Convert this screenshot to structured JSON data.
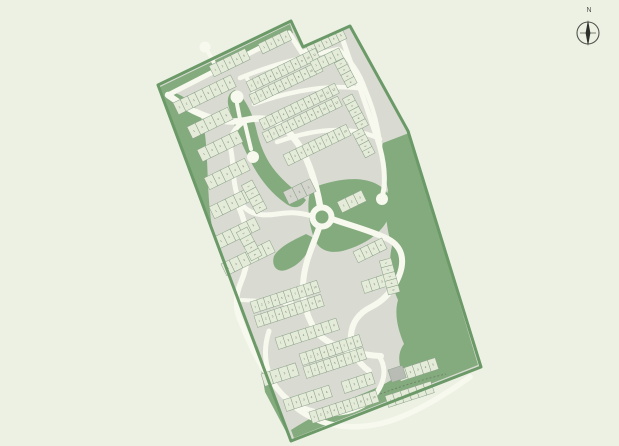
{
  "compass": {
    "label": "N"
  },
  "palette": {
    "background": "#edf1e4",
    "site_fabric": "#d9dbd2",
    "boundary_green": "#6b9a68",
    "open_space_green": "#84ab7d",
    "road": "#f7f8ee",
    "plot_fill": "#e4ebd8",
    "plot_stroke": "#8ba18b",
    "plot_gray": "#d3d5cc",
    "patch_gray": "#b8bcb4",
    "number_ink": "#44503f",
    "compass_ink": "#2c302b"
  },
  "map": {
    "site_outline": "M158,85 L291,21 L303,47 L350,26 L408,131 L481,367 L291,441 Z",
    "green_areas": [
      "M409,133 L478,365 L294,438 L291,430 C310,418 330,407 352,398 C372,390 390,383 402,372 C398,362 398,352 404,344 C398,330 394,314 398,300 C390,282 388,262 392,246 C386,228 384,206 388,190 C384,172 380,152 383,143 Z",
      "M160,88 C186,94 200,106 204,128 C209,156 206,196 213,232 L212,233 Z",
      "M160,87 L290,24 L293,33 L167,97 Z",
      "M235,90 C245,98 252,112 256,128 C260,146 266,160 276,172 C288,186 298,192 306,200 C300,209 293,209 285,203 C271,193 259,178 251,162 C241,143 234,126 229,108 C226,99 229,92 235,90 Z",
      "M312,188 C332,180 356,176 372,182 C388,188 394,200 390,214 C384,232 366,244 346,250 C330,255 318,250 314,238 C308,222 306,198 312,188 Z",
      "M314,238 C308,256 298,266 286,270 C277,273 271,266 274,256 C280,246 294,240 306,234 Z",
      "M257,345 L291,441 L265,392 Z"
    ],
    "roads": [
      {
        "d": "M168,95 L289,33 L302,53 L341,35",
        "w": 5
      },
      {
        "d": "M341,35 C356,78 369,112 380,148 C386,170 385,188 382,197",
        "w": 5
      },
      {
        "d": "M168,95 C198,117 224,125 246,120 C270,115 282,122 296,141 C309,158 317,188 320,206",
        "w": 6.5
      },
      {
        "d": "M332,219 C352,226 372,231 388,239 C403,247 405,261 399,276 C393,291 383,301 371,307 C359,313 352,322 351,335 C350,350 357,362 369,371",
        "w": 6
      },
      {
        "d": "M319,228 C312,248 304,263 303,285 C302,303 308,319 317,333 C331,347 357,355 381,356",
        "w": 6
      },
      {
        "d": "M312,216 C298,212 288,212 277,214 C258,217 244,213 238,197 C232,181 234,164 231,151 C228,137 235,127 246,120",
        "w": 5
      },
      {
        "d": "M238,205 C250,232 251,258 241,282 C235,296 235,310 241,322 C253,353 269,385 295,407 C321,428 357,432 393,420 C421,410 449,392 470,377",
        "w": 5.5
      },
      {
        "d": "M269,331 C259,362 271,392 299,406 C330,420 361,413 375,395 C385,382 387,368 379,356",
        "w": 5
      },
      {
        "d": "M240,78 C276,63 309,56 338,49",
        "w": 4.5
      },
      {
        "d": "M254,104 C296,89 332,84 365,89",
        "w": 4.5
      },
      {
        "d": "M277,142 C316,128 351,125 380,139",
        "w": 4.5
      },
      {
        "d": "M338,49 C352,61 360,74 365,89",
        "w": 4.5
      },
      {
        "d": "M365,89 C374,110 379,129 380,148",
        "w": 4.5
      },
      {
        "d": "M246,76 L257,101",
        "w": 4
      },
      {
        "d": "M244,120 L251,149",
        "w": 4
      },
      {
        "d": "M241,300 L284,302",
        "w": 4
      },
      {
        "d": "M237,104 L240,119",
        "w": 4
      },
      {
        "d": "M207,50 L214,63",
        "w": 4
      }
    ],
    "culs_de_sac": [
      {
        "x": 237,
        "y": 97,
        "r": 6.5
      },
      {
        "x": 253,
        "y": 157,
        "r": 6
      },
      {
        "x": 205,
        "y": 47,
        "r": 5.5
      },
      {
        "x": 382,
        "y": 199,
        "r": 6
      },
      {
        "x": 288,
        "y": 302,
        "r": 5.5
      }
    ],
    "roundabout": {
      "cx": 322,
      "cy": 217,
      "r": 9.5,
      "road_w": 6,
      "island_r": 4
    },
    "plot_rows": [
      {
        "x": 173,
        "y": 103,
        "rot": -26,
        "n": 8,
        "w": 8,
        "h": 13,
        "f": "g"
      },
      {
        "x": 209,
        "y": 66,
        "rot": -26,
        "n": 5,
        "w": 8,
        "h": 12,
        "f": "g"
      },
      {
        "x": 258,
        "y": 44,
        "rot": -26,
        "n": 4,
        "w": 8,
        "h": 11,
        "f": "g"
      },
      {
        "x": 306,
        "y": 46,
        "rot": -26,
        "n": 5,
        "w": 8,
        "h": 11,
        "f": "g"
      },
      {
        "x": 187,
        "y": 127,
        "rot": -26,
        "n": 5,
        "w": 9,
        "h": 13,
        "f": "g"
      },
      {
        "x": 246,
        "y": 82,
        "rot": -26,
        "n": 11,
        "w": 7,
        "h": 11,
        "f": "g"
      },
      {
        "x": 249,
        "y": 95,
        "rot": -26,
        "n": 11,
        "w": 7,
        "h": 11,
        "f": "g"
      },
      {
        "x": 259,
        "y": 120,
        "rot": -26,
        "n": 12,
        "w": 7,
        "h": 11,
        "f": "g"
      },
      {
        "x": 262,
        "y": 133,
        "rot": -26,
        "n": 12,
        "w": 7,
        "h": 11,
        "f": "g"
      },
      {
        "x": 283,
        "y": 155,
        "rot": -26,
        "n": 10,
        "w": 7,
        "h": 12,
        "f": "g"
      },
      {
        "x": 310,
        "y": 62,
        "rot": -26,
        "n": 4,
        "w": 8,
        "h": 11,
        "f": "g"
      },
      {
        "x": 344,
        "y": 58,
        "rot": 62,
        "n": 4,
        "w": 7,
        "h": 11,
        "f": "g"
      },
      {
        "x": 352,
        "y": 94,
        "rot": 62,
        "n": 5,
        "w": 7,
        "h": 11,
        "f": "g"
      },
      {
        "x": 362,
        "y": 128,
        "rot": 62,
        "n": 4,
        "w": 7,
        "h": 11,
        "f": "g"
      },
      {
        "x": 197,
        "y": 150,
        "rot": -26,
        "n": 5,
        "w": 9,
        "h": 13,
        "f": "g"
      },
      {
        "x": 204,
        "y": 178,
        "rot": -26,
        "n": 5,
        "w": 9,
        "h": 13,
        "f": "g"
      },
      {
        "x": 209,
        "y": 207,
        "rot": -26,
        "n": 5,
        "w": 9,
        "h": 13,
        "f": "g"
      },
      {
        "x": 214,
        "y": 237,
        "rot": -26,
        "n": 5,
        "w": 9,
        "h": 13,
        "f": "g"
      },
      {
        "x": 221,
        "y": 264,
        "rot": -26,
        "n": 6,
        "w": 9,
        "h": 13,
        "f": "g"
      },
      {
        "x": 247,
        "y": 227,
        "rot": 62,
        "n": 4,
        "w": 8,
        "h": 12,
        "f": "g"
      },
      {
        "x": 252,
        "y": 180,
        "rot": 62,
        "n": 4,
        "w": 8,
        "h": 12,
        "f": "g"
      },
      {
        "x": 283,
        "y": 192,
        "rot": -26,
        "n": 3,
        "w": 10,
        "h": 14,
        "f": "y"
      },
      {
        "x": 337,
        "y": 202,
        "rot": -26,
        "n": 3,
        "w": 9,
        "h": 12,
        "f": "g"
      },
      {
        "x": 353,
        "y": 252,
        "rot": -26,
        "n": 4,
        "w": 8,
        "h": 12,
        "f": "g"
      },
      {
        "x": 361,
        "y": 282,
        "rot": -18,
        "n": 4,
        "w": 8,
        "h": 12,
        "f": "g"
      },
      {
        "x": 391,
        "y": 258,
        "rot": 75,
        "n": 5,
        "w": 7,
        "h": 12,
        "f": "g"
      },
      {
        "x": 250,
        "y": 302,
        "rot": -18,
        "n": 10,
        "w": 7,
        "h": 12,
        "f": "g"
      },
      {
        "x": 254,
        "y": 316,
        "rot": -18,
        "n": 10,
        "w": 7,
        "h": 12,
        "f": "g"
      },
      {
        "x": 275,
        "y": 338,
        "rot": -18,
        "n": 8,
        "w": 8,
        "h": 12,
        "f": "g"
      },
      {
        "x": 299,
        "y": 354,
        "rot": -18,
        "n": 9,
        "w": 7,
        "h": 12,
        "f": "g"
      },
      {
        "x": 303,
        "y": 367,
        "rot": -18,
        "n": 9,
        "w": 7,
        "h": 12,
        "f": "g"
      },
      {
        "x": 261,
        "y": 374,
        "rot": -18,
        "n": 4,
        "w": 9,
        "h": 13,
        "f": "g"
      },
      {
        "x": 283,
        "y": 400,
        "rot": -18,
        "n": 6,
        "w": 8,
        "h": 12,
        "f": "g"
      },
      {
        "x": 309,
        "y": 412,
        "rot": -18,
        "n": 10,
        "w": 7,
        "h": 12,
        "f": "g"
      },
      {
        "x": 385,
        "y": 396,
        "rot": -18,
        "n": 6,
        "w": 8,
        "h": 12,
        "f": "g"
      },
      {
        "x": 397,
        "y": 370,
        "rot": -18,
        "n": 5,
        "w": 8,
        "h": 12,
        "f": "g"
      },
      {
        "x": 341,
        "y": 382,
        "rot": -18,
        "n": 4,
        "w": 8,
        "h": 12,
        "f": "g"
      }
    ],
    "gray_patch": {
      "x": 388,
      "y": 370,
      "w": 15,
      "h": 13,
      "rot": -18
    },
    "dashed_boundary": "M380,394 C402,386 424,379 446,374",
    "compass": {
      "cx": 588,
      "cy": 33,
      "r": 11
    }
  }
}
